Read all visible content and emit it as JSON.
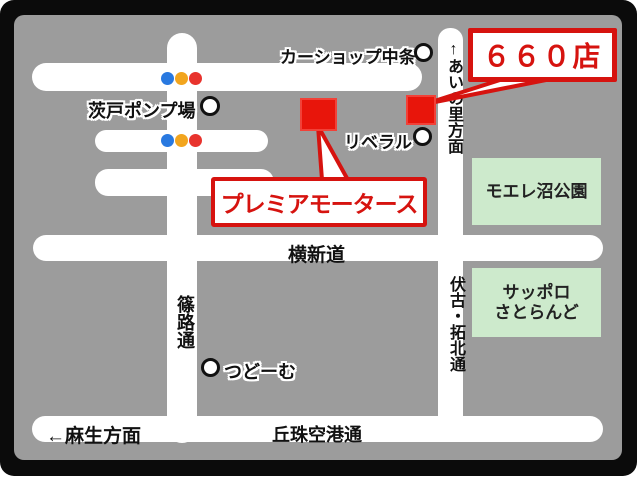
{
  "badge": {
    "label": "６６０店"
  },
  "dealer": {
    "name": "プレミアモータース"
  },
  "landmarks": {
    "carshop": "カーショップ中条",
    "pump_station": "茨戸ポンプ場",
    "liberal": "リベラル",
    "tsudome": "つどーむ"
  },
  "roads": {
    "yokoshindo": "横新道",
    "shinoro_dori": "篠路通",
    "fushiko_takuhoku_dori": "伏古・拓北通",
    "ainosato_direction": "↑あいの里方面",
    "asabu_direction": "←麻生方面",
    "okadama_airport_dori": "丘珠空港通"
  },
  "parks": {
    "moere_numa_park": "モエレ沼公園",
    "sapporo_satoland_line1": "サッポロ",
    "sapporo_satoland_line2": "さとらんど"
  },
  "colors": {
    "accent_red": "#d6130f",
    "marker_red": "#e8150b",
    "map_gray": "#9c9c9c",
    "road_white": "#ffffff",
    "park_green": "#cdeacc",
    "frame_black": "#0b0b0b",
    "signal_blue": "#2979e0",
    "signal_yellow": "#f2a51e",
    "signal_red": "#e8332d"
  }
}
